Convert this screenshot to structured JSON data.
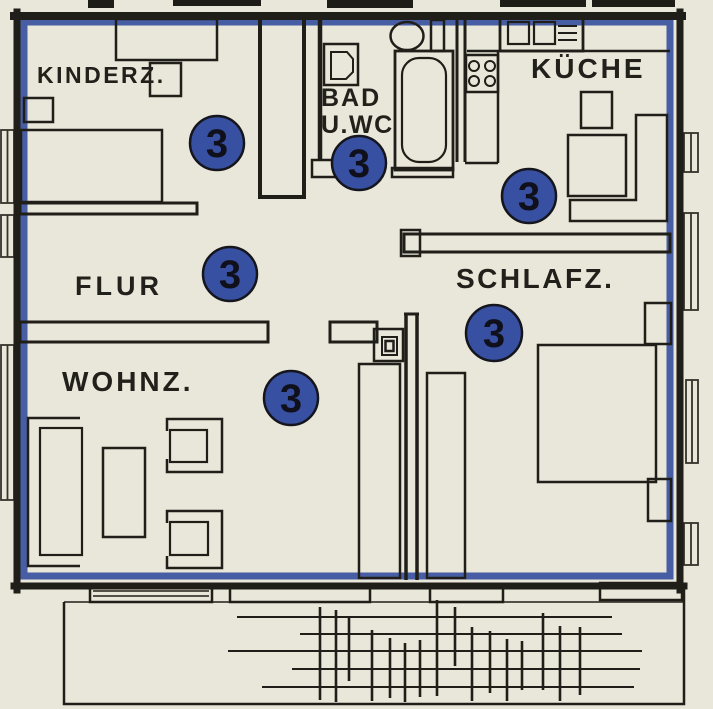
{
  "document": {
    "type": "apartment-floor-plan",
    "unit_number": "3"
  },
  "rooms": [
    {
      "id": "kinderzimmer",
      "label": "KINDERZ."
    },
    {
      "id": "bad-wc",
      "label": "BAD",
      "label_line2": "U.WC"
    },
    {
      "id": "kueche",
      "label": "KÜCHE"
    },
    {
      "id": "flur",
      "label": "FLUR"
    },
    {
      "id": "schlafzimmer",
      "label": "SCHLAFZ."
    },
    {
      "id": "wohnzimmer",
      "label": "WOHNZ."
    }
  ],
  "unit_markers": [
    {
      "room": "kinderzimmer",
      "value": "3"
    },
    {
      "room": "bad-wc",
      "value": "3"
    },
    {
      "room": "kueche",
      "value": "3"
    },
    {
      "room": "flur",
      "value": "3"
    },
    {
      "room": "schlafzimmer",
      "value": "3"
    },
    {
      "room": "wohnzimmer",
      "value": "3"
    }
  ],
  "colors": {
    "paper": "#e9e7d9",
    "ink": "#201e18",
    "boundary_blue": "#3a539f",
    "marker_blue": "#3850a2"
  }
}
